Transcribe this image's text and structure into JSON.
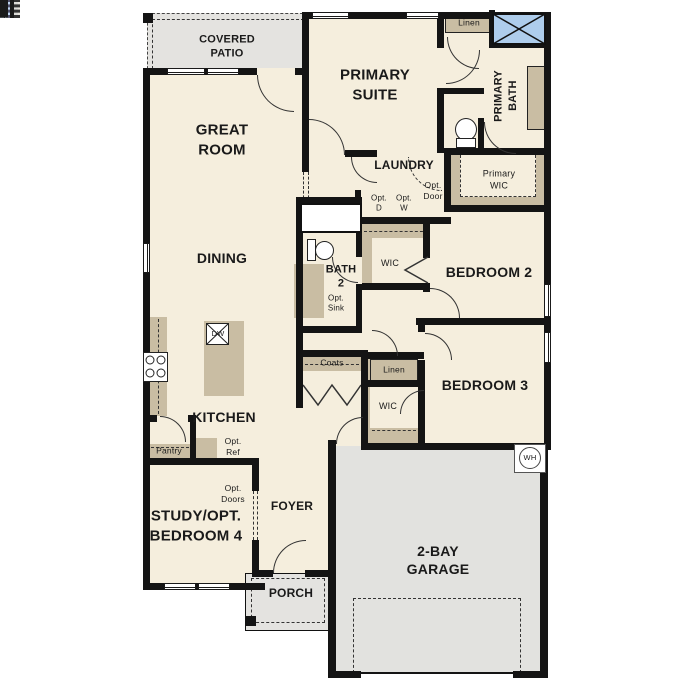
{
  "plan": {
    "colors": {
      "floor": "#f5eedd",
      "patio": "#e4e3e0",
      "garage": "#e2e2df",
      "wall": "#141414",
      "blue": "#aecdec",
      "tan": "#c9bda3",
      "optbox": "#dcdcd8"
    },
    "rooms": {
      "covered_patio": "COVERED\nPATIO",
      "great_room": "GREAT\nROOM",
      "primary_suite": "PRIMARY\nSUITE",
      "dining": "DINING",
      "kitchen": "KITCHEN",
      "laundry": "LAUNDRY",
      "primary_bath": "PRIMARY\nBATH",
      "primary_wic": "Primary\nWIC",
      "bath2": "BATH\n2",
      "bedroom2": "BEDROOM 2",
      "bedroom3": "BEDROOM 3",
      "study": "STUDY/OPT.\nBEDROOM 4",
      "foyer": "FOYER",
      "porch": "PORCH",
      "garage": "2-BAY\nGARAGE"
    },
    "closets": {
      "linen_bath": "Linen",
      "linen_hall": "Linen",
      "coats": "Coats",
      "wic_bed2": "WIC",
      "wic_bed3": "WIC",
      "pantry": "Pantry"
    },
    "options": {
      "opt_dryer": "Opt.\nD",
      "opt_washer": "Opt.\nW",
      "opt_door": "Opt.\nDoor",
      "opt_sink": "Opt.\nSink",
      "opt_ref": "Opt.\nRef",
      "opt_doors": "Opt.\nDoors"
    },
    "appliances": {
      "dishwasher": "DW",
      "water_heater": "WH"
    }
  }
}
